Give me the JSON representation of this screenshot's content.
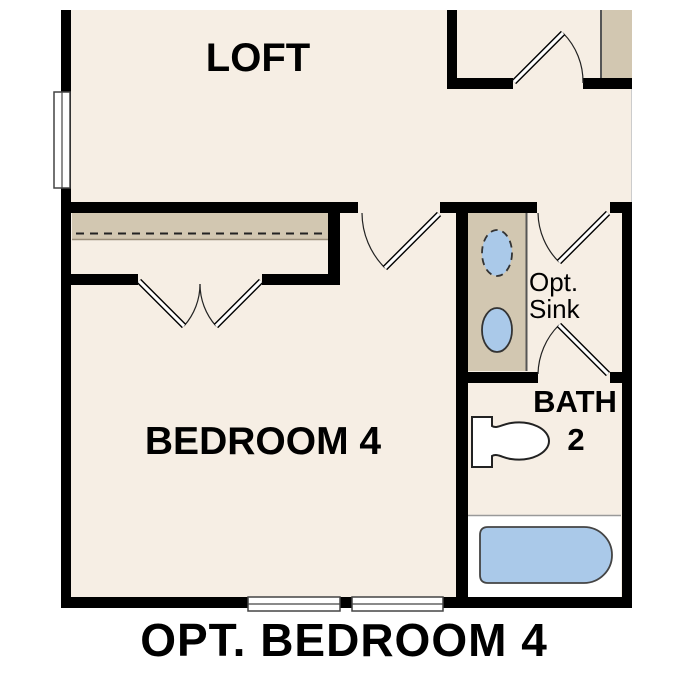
{
  "plan": {
    "caption": "OPT. BEDROOM 4",
    "labels": {
      "loft": "LOFT",
      "bedroom": "BEDROOM 4",
      "bath_line1": "BATH",
      "bath_line2": "2",
      "sink_line1": "Opt.",
      "sink_line2": "Sink"
    },
    "colors": {
      "background": "#ffffff",
      "floor": "#f6eee4",
      "cabinet": "#d2c7b1",
      "fixture_blue": "#aac9e9",
      "wall": "#000000",
      "fixture_white": "#ffffff"
    }
  }
}
